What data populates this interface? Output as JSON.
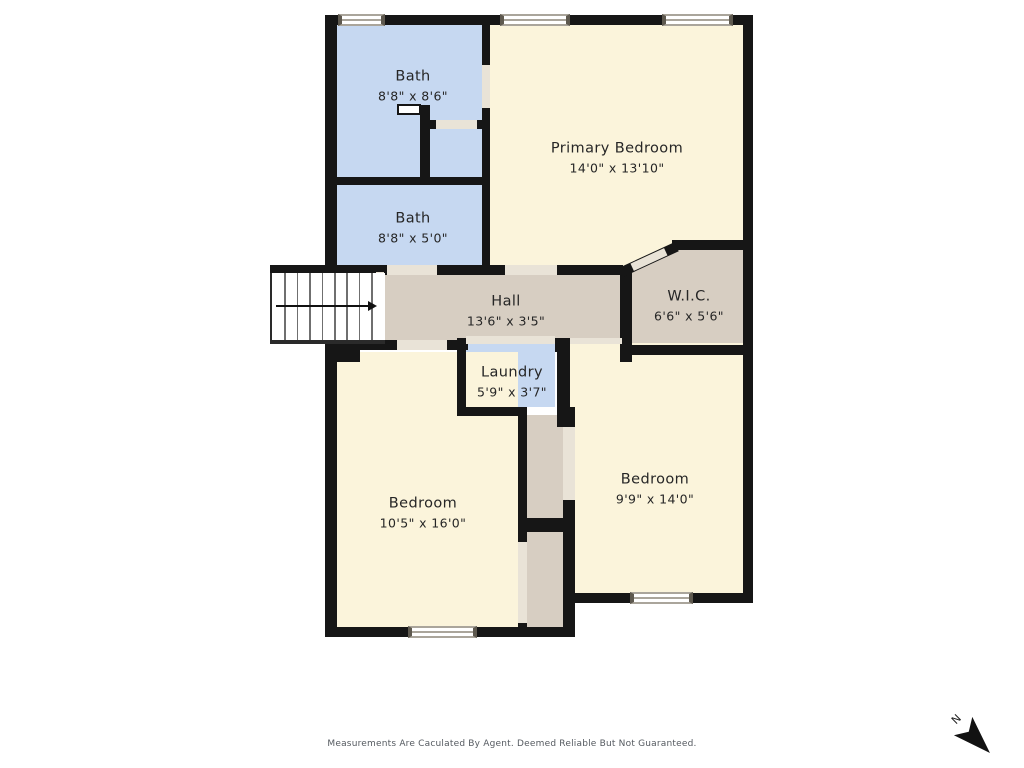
{
  "meta": {
    "disclaimer": "Measurements Are Caculated By Agent. Deemed Reliable But Not Guaranteed.",
    "north_label": "N"
  },
  "rooms": [
    {
      "id": "bath-upper",
      "label": "Bath",
      "dims": "8'8\" x 8'6\""
    },
    {
      "id": "bath-lower",
      "label": "Bath",
      "dims": "8'8\" x 5'0\""
    },
    {
      "id": "primary-bedroom",
      "label": "Primary Bedroom",
      "dims": "14'0\" x 13'10\""
    },
    {
      "id": "hall",
      "label": "Hall",
      "dims": "13'6\" x 3'5\""
    },
    {
      "id": "wic",
      "label": "W.I.C.",
      "dims": "6'6\" x 5'6\""
    },
    {
      "id": "laundry",
      "label": "Laundry",
      "dims": "5'9\" x 3'7\""
    },
    {
      "id": "bedroom-left",
      "label": "Bedroom",
      "dims": "10'5\" x 16'0\""
    },
    {
      "id": "bedroom-right",
      "label": "Bedroom",
      "dims": "9'9\" x 14'0\""
    }
  ],
  "colors": {
    "wall": "#161616",
    "floor_cream": "#fbf4db",
    "floor_blue": "#c6d8f1",
    "floor_tan": "#d7cec2",
    "door_opening": "#e9e3d7",
    "window_frame": "#aaa59b",
    "text": "#262626",
    "disclaimer_text": "#555a60"
  }
}
